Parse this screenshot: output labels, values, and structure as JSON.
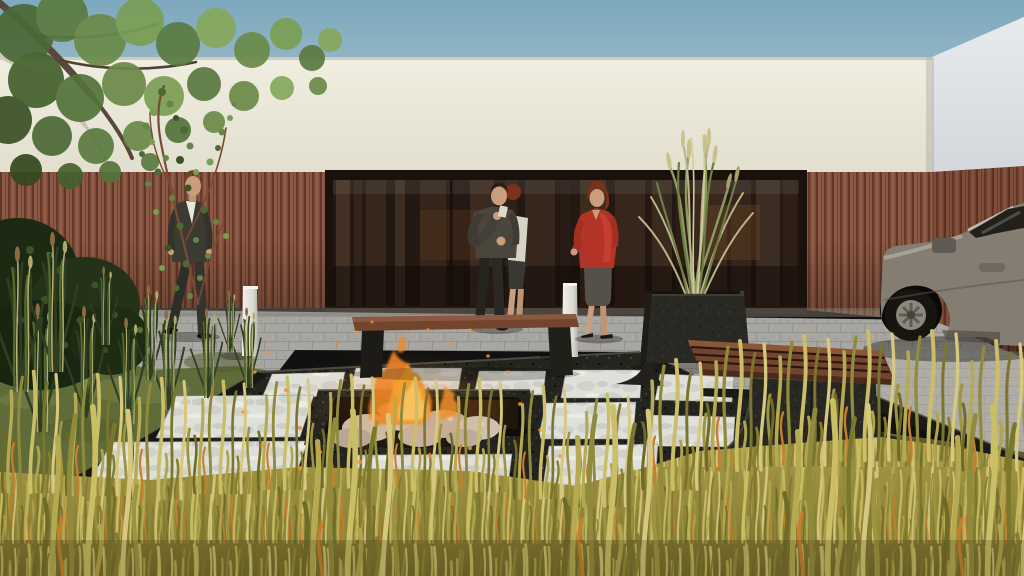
{
  "meta": {
    "title": "Exterior 3D visualization — courtyard terrace with sunken fire pit",
    "type": "architectural render",
    "width": 1024,
    "height": 576
  },
  "palette": {
    "sky_top": "#7da8bd",
    "sky_horizon": "#c9d7da",
    "wall_cream": "#eae7d9",
    "wall_side": "#dde1e4",
    "timber": "#8a5843",
    "timber_dark": "#5e362a",
    "glass": "#241812",
    "glass_frame": "#1b110b",
    "paving": "#a7a59e",
    "patio_granite": "#23231e",
    "paver_white": "#dfdfd9",
    "curb": "#1b1b16",
    "lawn": "#5f6b38",
    "meadow": "#998d3e",
    "fire_orange": "#ee8422",
    "fire_yellow": "#fbd06a",
    "ember": "#f59030",
    "rock_light": "#cdbfb2",
    "bench_wood": "#74452e",
    "granite_furniture": "#2c2a24",
    "bollard": "#e8e8e0",
    "car_body": "#847e72",
    "car_glass": "#232019",
    "suit": "#3b3b32",
    "shirt_white": "#e9e7dd",
    "shirt_grey": "#4a463c",
    "jacket_red": "#b23427",
    "skirt_grey": "#55504a",
    "skin": "#c89e7e",
    "hair_brown": "#6b4326",
    "hair_dark": "#221b15",
    "hair_auburn": "#7c311d",
    "foliage_green": "#5b7a40",
    "ornamental_grass": "#b9b487"
  },
  "scene": {
    "setting": "Sunny courtyard terrace in front of a flat-roofed building",
    "sky": {
      "label": "clear hazy sky"
    },
    "building": {
      "label": "single-storey building",
      "upper_band": "cream rendered wall",
      "cladding": "vertical timber slat cladding",
      "glazing": "full-width dark glass wall with tree reflections"
    },
    "terrace": {
      "label": "black granite terrace",
      "pavers": "white stone slabs set in a grid",
      "paver_count_visible": 11,
      "fire_pit": {
        "label": "sunken square fire pit",
        "contents": "light rocks with burning fire",
        "embers": "floating orange sparks"
      }
    },
    "furniture": {
      "bench_left": {
        "label": "timber-top bench on dark legs"
      },
      "bench_right": {
        "label": "timber slat bench on curved granite plinth"
      },
      "planter": {
        "label": "granite planter with ornamental grass"
      },
      "bollards": [
        {
          "label": "white square bollard"
        },
        {
          "label": "white square bollard"
        }
      ]
    },
    "people": [
      {
        "label": "man in dark suit walking",
        "position": "left"
      },
      {
        "label": "man in grey shirt holding a drink",
        "position": "centre"
      },
      {
        "label": "person with auburn hair partly hidden",
        "position": "behind centre man"
      },
      {
        "label": "woman in red jacket and grey skirt",
        "position": "centre-right"
      }
    ],
    "vehicle": {
      "label": "grey sedan, front half visible",
      "position": "right edge, parked on pavers"
    },
    "vegetation": {
      "tree": "leafy tree canopy, top left",
      "vine": "climbing vine on cream wall",
      "shrub": "dark shrub, far left",
      "lawn": "olive lawn with grass tufts",
      "meadow": "tall unmown yellow-green grass in foreground"
    }
  }
}
